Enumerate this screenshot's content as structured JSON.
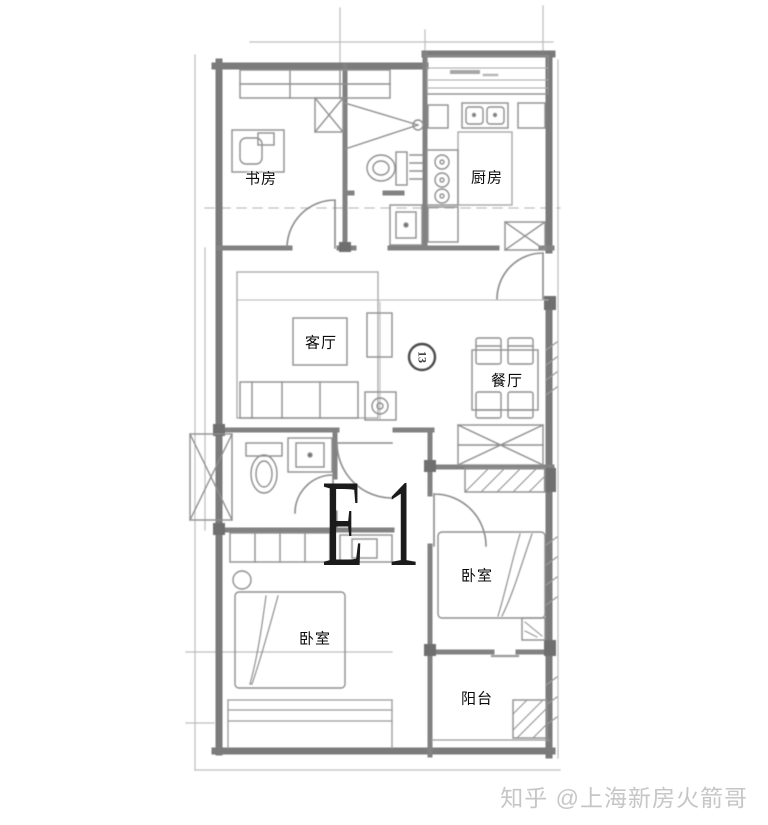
{
  "plan": {
    "unit_code": "E1",
    "axis_marker": "13",
    "rooms": [
      {
        "id": "study",
        "label": "书房"
      },
      {
        "id": "kitchen",
        "label": "厨房"
      },
      {
        "id": "living-room",
        "label": "客厅"
      },
      {
        "id": "dining-room",
        "label": "餐厅"
      },
      {
        "id": "bedroom-right",
        "label": "卧室"
      },
      {
        "id": "bedroom-left",
        "label": "卧室"
      },
      {
        "id": "balcony",
        "label": "阳台"
      }
    ]
  },
  "watermark": {
    "text": "知乎 @上海新房火箭哥"
  },
  "colors": {
    "background": "#ffffff",
    "wall": "#7b7b7b",
    "line": "#8f8f8f",
    "light_line": "#b5b5b5",
    "label": "#0a0a0a",
    "unit_code": "#1b1b1b",
    "watermark": "#c6c6c6"
  }
}
